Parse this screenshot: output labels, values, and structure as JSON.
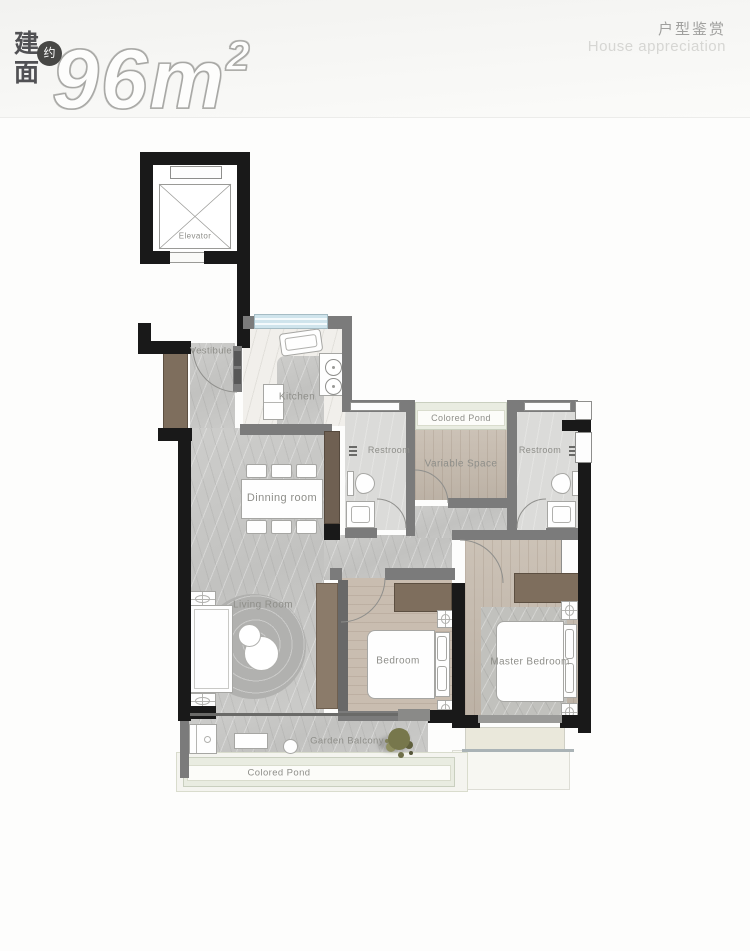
{
  "header": {
    "area_char_1": "建",
    "area_char_2": "面",
    "approx_badge": "约",
    "area_value": "96m",
    "area_exponent": "2",
    "section_title_cn": "户型鉴赏",
    "section_title_en": "House appreciation"
  },
  "plan": {
    "elevator_label": "Elevator",
    "vestibule_label": "Vestibule",
    "kitchen_label": "Kitchen",
    "pond_top_label": "Colored Pond",
    "restroom_left_label": "Restroom",
    "restroom_right_label": "Restroom",
    "variable_space_label": "Variable Space",
    "dining_label": "Dinning room",
    "living_label": "Living Room",
    "bedroom_label": "Bedroom",
    "master_bedroom_label": "Master Bedroom",
    "balcony_label": "Garden Balcony",
    "pond_bottom_label": "Colored Pond"
  },
  "colors": {
    "wall_black": "#191919",
    "wall_gray": "#7b7b7b",
    "marble_floor": "#c8c8c6",
    "wood_floor": "#c6bbae",
    "wood_dark": "#7e6e5d",
    "pond_green": "#e9ece1",
    "window_blue": "#cfe4ec",
    "label_gray": "#8e8e89",
    "accent_dark": "#474745"
  }
}
